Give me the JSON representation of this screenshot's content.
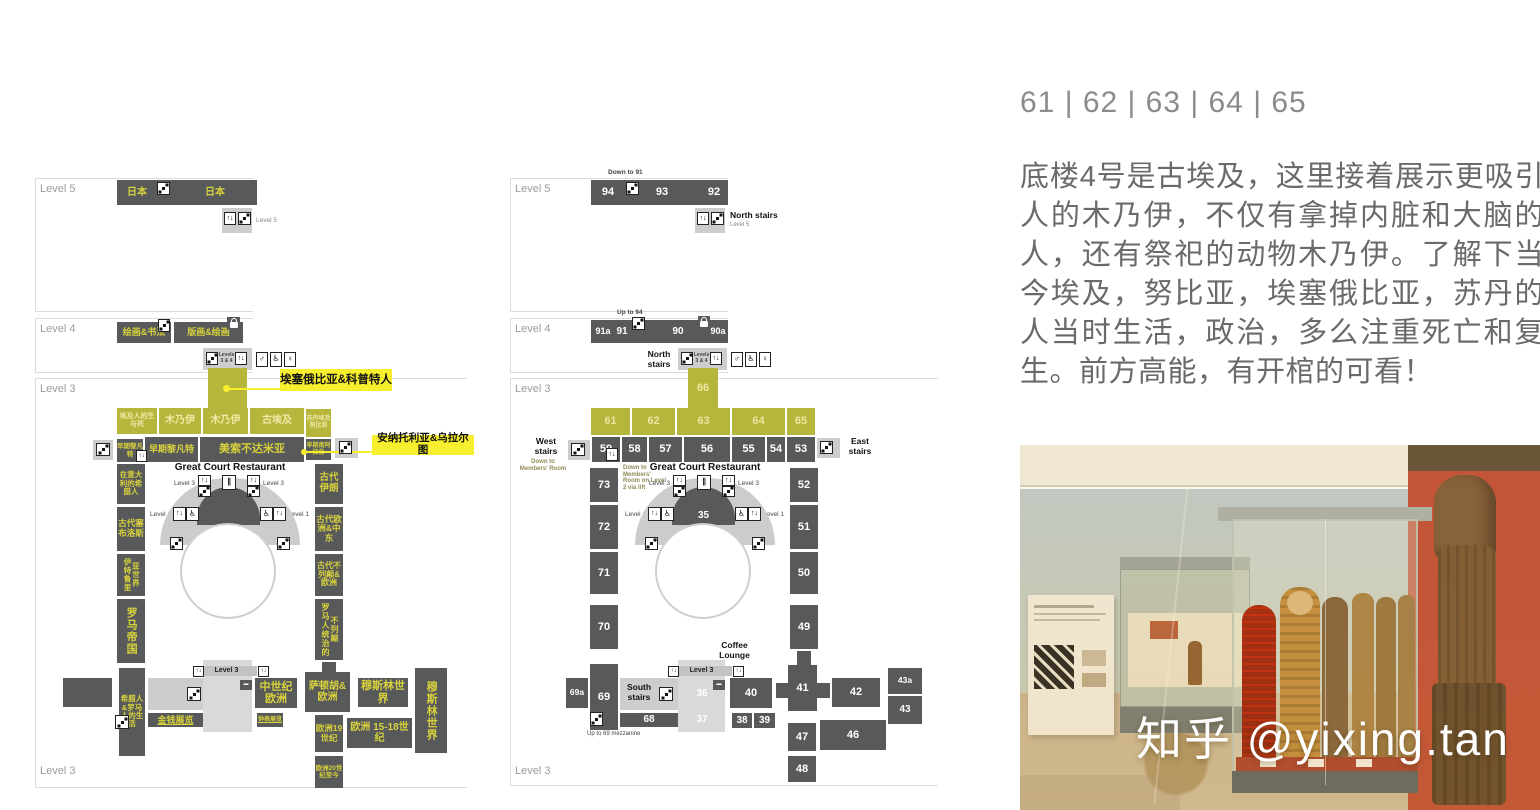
{
  "icons": {
    "lift": "↑↓",
    "male": "♂",
    "female": "♀",
    "wheelchair": "♿",
    "restaurant": "∥",
    "shop": "▬"
  },
  "lm": {
    "lv5": "Level 5",
    "lv4": "Level 4",
    "lv3": "Level 3",
    "lv3_bottom": "Level 3",
    "japan1": "日本",
    "japan2": "日本",
    "lv5_note": "Level 5",
    "paint": "绘画&书法",
    "prints": "版画&绘画",
    "levels34": "Levels 3 & 4",
    "callout_ethiopia": "埃塞俄比亚&科普特人",
    "callout_anatolia": "安纳托利亚&乌拉尔图",
    "y": [
      "埃及人的生与死",
      "木乃伊",
      "木乃伊",
      "古埃及",
      "苏丹埃及努比亚"
    ],
    "n": [
      "早期黎凡特",
      "早期黎凡特",
      "美索不达米亚",
      "早期南阿拉伯"
    ],
    "w": [
      "在意大利的希腊人",
      "古代塞布洛斯",
      "伊特鲁里亚世界",
      "罗马帝国",
      "希腊人&罗马人的生活"
    ],
    "e": [
      "古代伊朗",
      "古代欧洲&中东",
      "古代不列颠&欧洲",
      "罗马人统治的不列颠"
    ],
    "restaurant": "Great Court Restaurant",
    "lv3_small": "Level 3",
    "lv1_small": "Level 1",
    "strip": "Level 3",
    "money": "金钱展览",
    "clocks": "钟表展览",
    "medieval": "中世纪欧洲",
    "sutton": "萨顿胡&欧洲",
    "muslim": "穆斯林世界",
    "muslim_v": "穆斯林世界",
    "eur19": "欧洲19世纪",
    "eur1518": "欧洲 15-18世纪",
    "eur20": "欧洲20世纪至今"
  },
  "rm": {
    "lv5": "Level 5",
    "lv4": "Level 4",
    "lv3": "Level 3",
    "lv3_bottom": "Level 3",
    "down91": "Down to 91",
    "up94": "Up to 94",
    "r94": "94",
    "r93": "93",
    "r92": "92",
    "north5": "North stairs",
    "north5_lv": "Level 5",
    "r91a": "91a",
    "r91": "91",
    "r90": "90",
    "r90a": "90a",
    "north4": "North stairs",
    "levels34": "Levels 3 & 4",
    "r66": "66",
    "y": [
      "61",
      "62",
      "63",
      "64",
      "65"
    ],
    "west": "West stairs",
    "west_note": "Down to Members' Room",
    "east": "East stairs",
    "n": [
      "59",
      "58",
      "57",
      "56",
      "55",
      "54",
      "53"
    ],
    "members_lift": "Down to Members' Room on Level 2 via lift",
    "w": [
      "73",
      "72",
      "71",
      "70"
    ],
    "e": [
      "52",
      "51",
      "50",
      "49"
    ],
    "restaurant": "Great Court Restaurant",
    "r35": "35",
    "lv3_small": "Level 3",
    "lv1_small": "Level 1",
    "strip": "Level 3",
    "r69a": "69a",
    "r69": "69",
    "south": "South stairs",
    "r36": "36",
    "r37": "37",
    "r68": "68",
    "r38": "38",
    "r39": "39",
    "r40": "40",
    "coffee": "Coffee Lounge",
    "r41": "41",
    "r42": "42",
    "r43a": "43a",
    "r43": "43",
    "r46": "46",
    "r47": "47",
    "r48": "48",
    "mezz": "Up to 69 mezzanine"
  },
  "article": {
    "title": "61 | 62 | 63 | 64 | 65",
    "body": "底楼4号是古埃及，这里接着展示更吸引人的木乃伊，不仅有拿掉内脏和大脑的人，还有祭祀的动物木乃伊。了解下当今埃及，努比亚，埃塞俄比亚，苏丹的人当时生活，政治，多么注重死亡和复生。前方高能，有开棺的可看！"
  },
  "photo": {
    "watermark": "知乎 @yixing.tan"
  },
  "colors": {
    "room_dark": "#58595b",
    "room_yellow": "#b7b63c",
    "highlight_yellow": "#f7ef2d",
    "label_yellow": "#d8d23c",
    "red_wall": "#bf4733"
  }
}
